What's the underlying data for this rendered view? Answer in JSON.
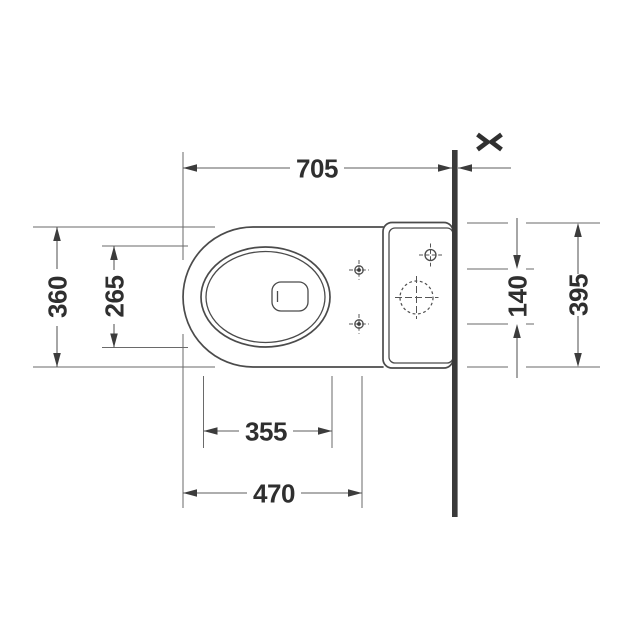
{
  "diagram": {
    "dims": {
      "top": "705",
      "left_outer": "360",
      "left_inner": "265",
      "bottom_inner": "355",
      "bottom_outer": "470",
      "right_inner": "140",
      "right_outer": "395"
    },
    "colors": {
      "background": "#ffffff",
      "outline": "#4b4b4b",
      "dimension_line": "#5d5d5d",
      "text": "#2f2f2f",
      "wall": "#3a3a3a"
    }
  }
}
